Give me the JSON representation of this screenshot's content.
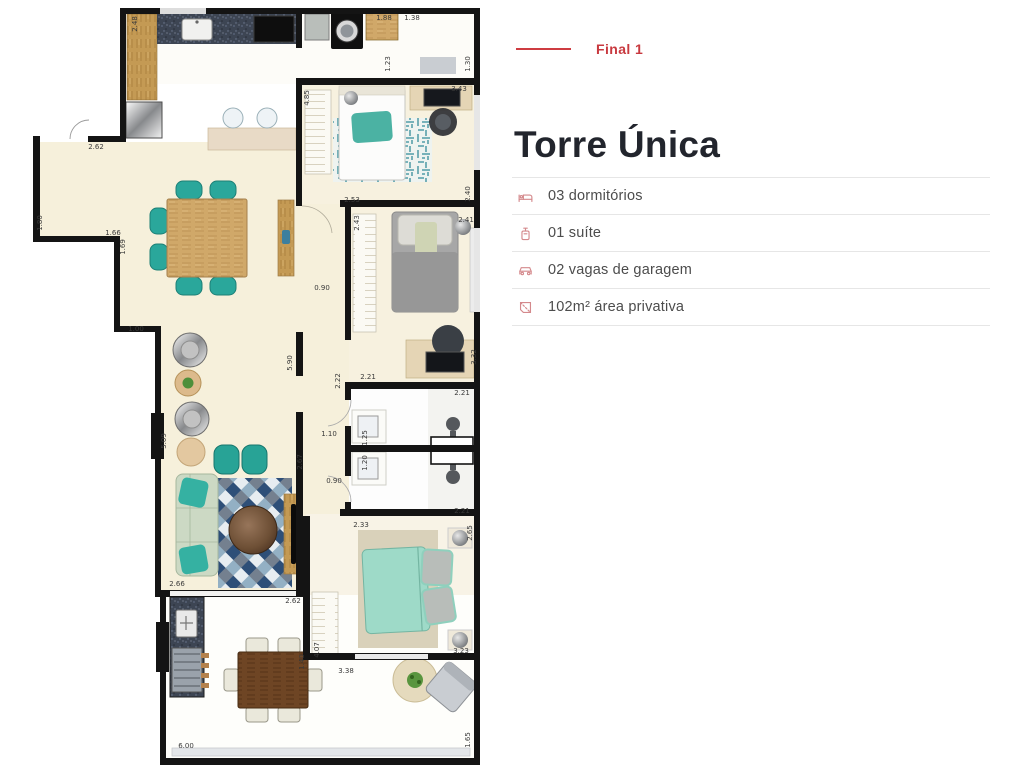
{
  "colors": {
    "accent_red": "#c8393f",
    "icon_rose": "#d4898c",
    "divider": "#e6e6e6",
    "title_dark": "#22252d",
    "feature_text": "#4c4c4c",
    "floor_cream": "#f6f0db",
    "teal_furniture": "#2aa79b",
    "wall_black": "#141414"
  },
  "panel": {
    "final_label": "Final 1",
    "title": "Torre Única",
    "features": [
      {
        "icon": "bed-icon",
        "label": "03 dormitórios"
      },
      {
        "icon": "suite-icon",
        "label": "01 suíte"
      },
      {
        "icon": "car-icon",
        "label": "02 vagas de garagem"
      },
      {
        "icon": "area-icon",
        "label": "102m² área privativa"
      }
    ]
  },
  "floor_plan": {
    "labels": [
      {
        "text": "2.48",
        "x": 137,
        "y": 24,
        "v": true
      },
      {
        "text": "1.88",
        "x": 384,
        "y": 20,
        "v": false
      },
      {
        "text": "1.38",
        "x": 412,
        "y": 20,
        "v": false
      },
      {
        "text": "1.23",
        "x": 390,
        "y": 64,
        "v": true
      },
      {
        "text": "1.30",
        "x": 470,
        "y": 64,
        "v": true
      },
      {
        "text": "3.43",
        "x": 459,
        "y": 91,
        "v": false
      },
      {
        "text": "4.85",
        "x": 309,
        "y": 98,
        "v": true
      },
      {
        "text": "2.53",
        "x": 352,
        "y": 202,
        "v": false
      },
      {
        "text": "2.40",
        "x": 470,
        "y": 194,
        "v": true
      },
      {
        "text": "2.43",
        "x": 359,
        "y": 223,
        "v": true
      },
      {
        "text": "2.41",
        "x": 466,
        "y": 222,
        "v": false
      },
      {
        "text": "0.90",
        "x": 322,
        "y": 290,
        "v": false
      },
      {
        "text": "5.90",
        "x": 292,
        "y": 363,
        "v": true
      },
      {
        "text": "2.21",
        "x": 368,
        "y": 379,
        "v": false
      },
      {
        "text": "2.22",
        "x": 340,
        "y": 381,
        "v": true
      },
      {
        "text": "3.32",
        "x": 476,
        "y": 357,
        "v": true
      },
      {
        "text": "2.21",
        "x": 462,
        "y": 395,
        "v": false
      },
      {
        "text": "1.10",
        "x": 329,
        "y": 436,
        "v": false
      },
      {
        "text": "1.25",
        "x": 367,
        "y": 438,
        "v": true
      },
      {
        "text": "1.20",
        "x": 367,
        "y": 463,
        "v": true
      },
      {
        "text": "2.67",
        "x": 302,
        "y": 462,
        "v": true
      },
      {
        "text": "0.90",
        "x": 334,
        "y": 483,
        "v": false
      },
      {
        "text": "2.21",
        "x": 462,
        "y": 513,
        "v": false
      },
      {
        "text": "2.33",
        "x": 361,
        "y": 527,
        "v": false
      },
      {
        "text": "2.65",
        "x": 472,
        "y": 533,
        "v": true
      },
      {
        "text": "5.09",
        "x": 166,
        "y": 441,
        "v": true
      },
      {
        "text": "1.80",
        "x": 42,
        "y": 223,
        "v": true
      },
      {
        "text": "1.66",
        "x": 113,
        "y": 235,
        "v": false
      },
      {
        "text": "1.69",
        "x": 125,
        "y": 247,
        "v": true
      },
      {
        "text": "1.00",
        "x": 136,
        "y": 331,
        "v": false
      },
      {
        "text": "2.62",
        "x": 96,
        "y": 149,
        "v": false
      },
      {
        "text": "2.66",
        "x": 177,
        "y": 586,
        "v": false
      },
      {
        "text": "2.62",
        "x": 293,
        "y": 603,
        "v": false
      },
      {
        "text": "4.07",
        "x": 319,
        "y": 650,
        "v": true
      },
      {
        "text": "1.40",
        "x": 304,
        "y": 662,
        "v": true
      },
      {
        "text": "3.38",
        "x": 346,
        "y": 673,
        "v": false
      },
      {
        "text": "3.23",
        "x": 461,
        "y": 653,
        "v": false
      },
      {
        "text": "6.00",
        "x": 186,
        "y": 748,
        "v": false
      },
      {
        "text": "1.65",
        "x": 470,
        "y": 740,
        "v": true
      }
    ]
  }
}
